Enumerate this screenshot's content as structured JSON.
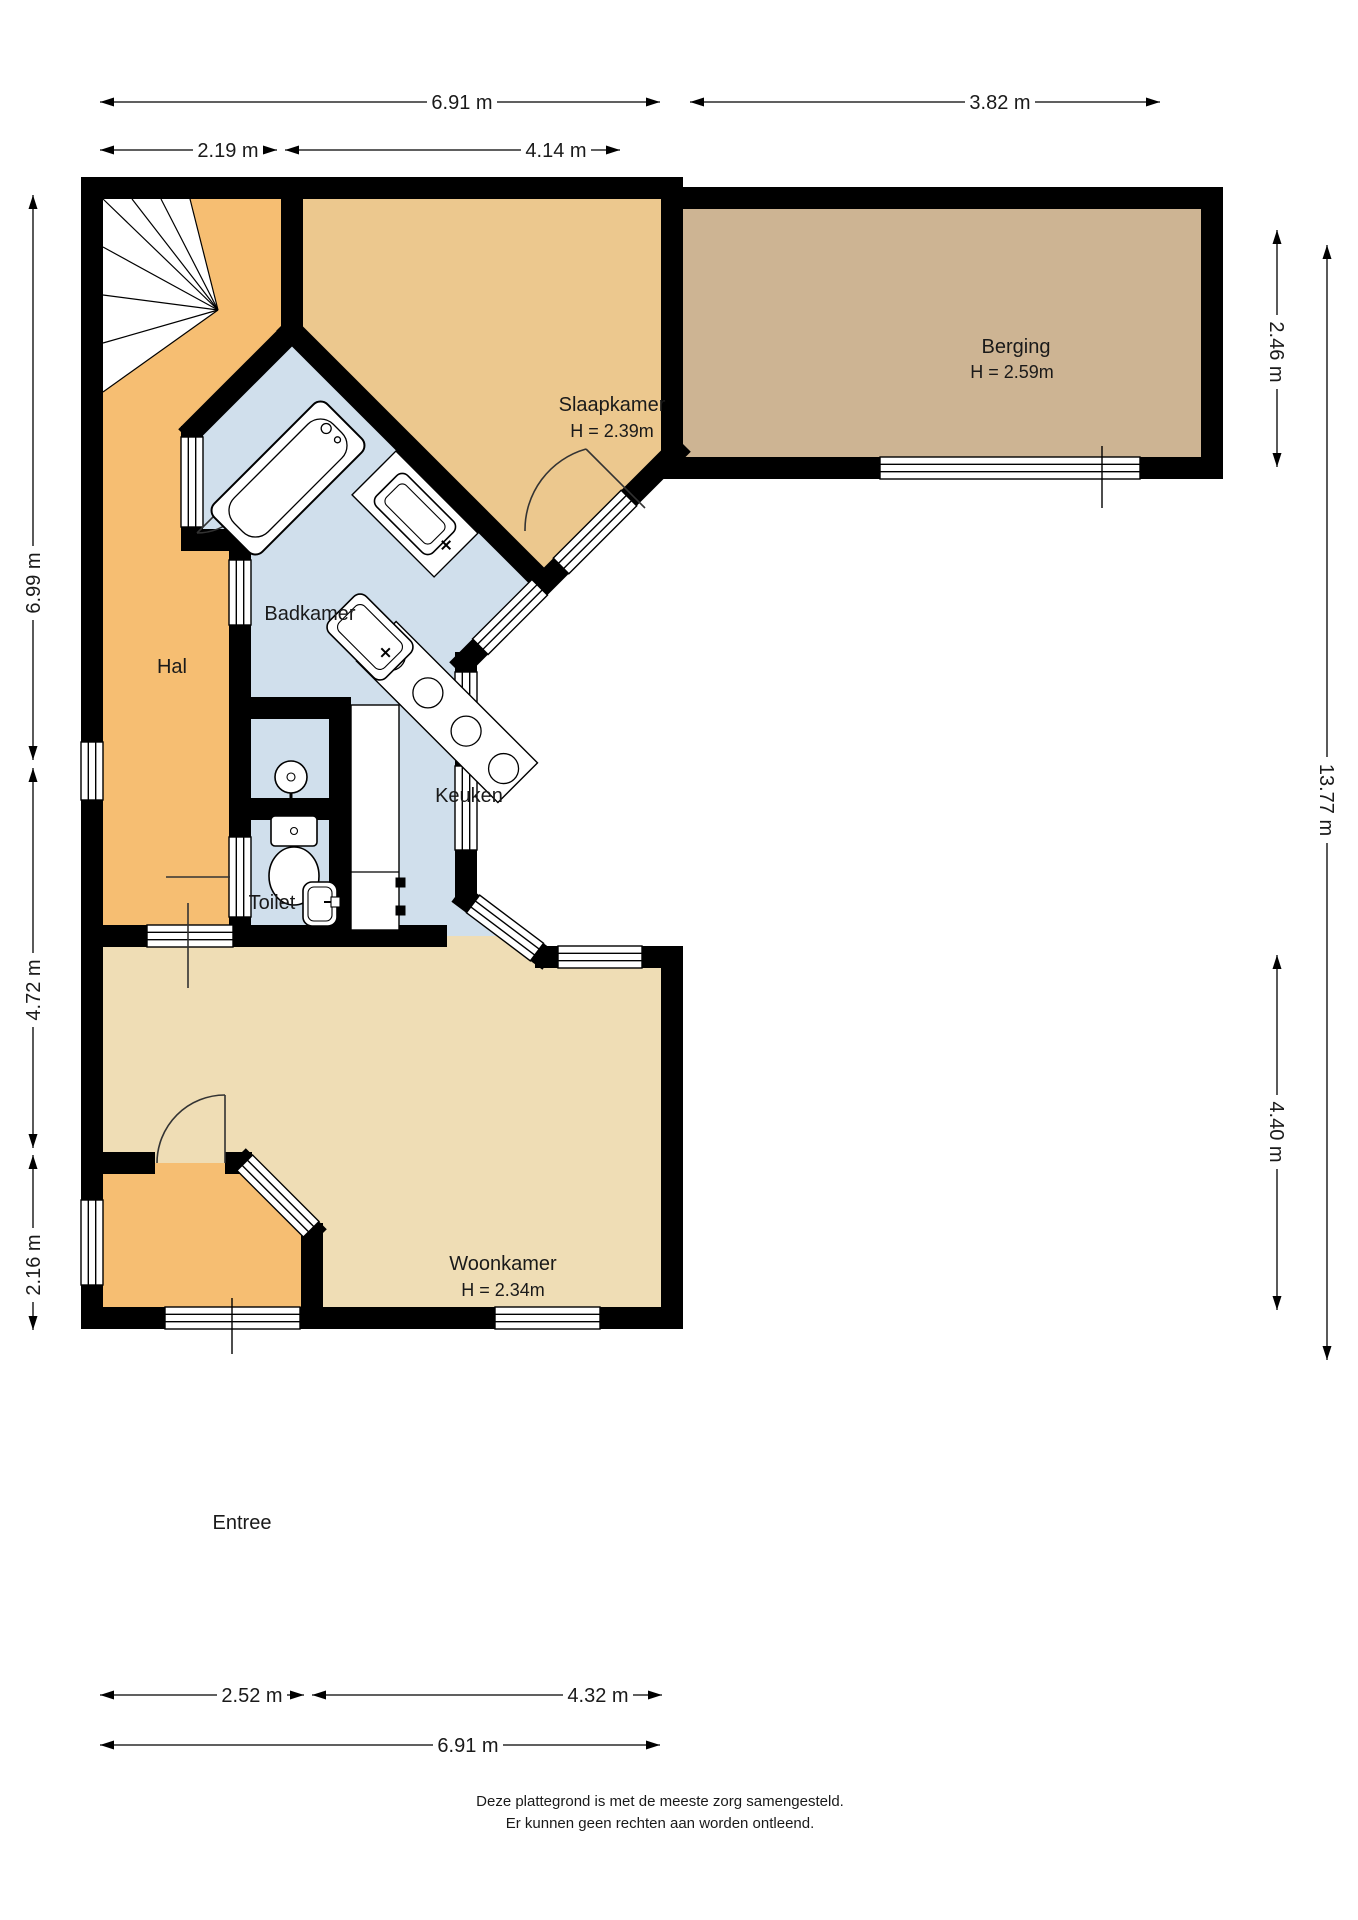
{
  "plan": {
    "rooms": {
      "slaapkamer": {
        "label": "Slaapkamer",
        "height": "H = 2.39m"
      },
      "berging": {
        "label": "Berging",
        "height": "H = 2.59m"
      },
      "badkamer": {
        "label": "Badkamer"
      },
      "hal": {
        "label": "Hal"
      },
      "keuken": {
        "label": "Keuken"
      },
      "toilet": {
        "label": "Toilet"
      },
      "woonkamer": {
        "label": "Woonkamer",
        "height": "H = 2.34m"
      },
      "entree": {
        "label": "Entree"
      }
    },
    "dimensions": {
      "top_total": "6.91 m",
      "top_hal": "2.19 m",
      "top_slaapkamer": "4.14 m",
      "top_berging": "3.82 m",
      "left_upper": "6.99 m",
      "left_middle": "4.72 m",
      "left_lower": "2.16 m",
      "right_berging": "2.46 m",
      "right_total": "13.77 m",
      "right_woonkamer": "4.40 m",
      "bottom_entree": "2.52 m",
      "bottom_woonkamer": "4.32 m",
      "bottom_total": "6.91 m"
    },
    "colors": {
      "hal": "#F6BE72",
      "entree": "#F6BE72",
      "slaapkamer": "#ECC88E",
      "berging": "#CDB493",
      "wet_rooms": "#D0DFEC",
      "woonkamer": "#EFDDB5",
      "walls": "#000000"
    },
    "footer": {
      "line1": "Deze plattegrond is met de meeste zorg samengesteld.",
      "line2": "Er kunnen geen rechten aan worden ontleend."
    }
  }
}
